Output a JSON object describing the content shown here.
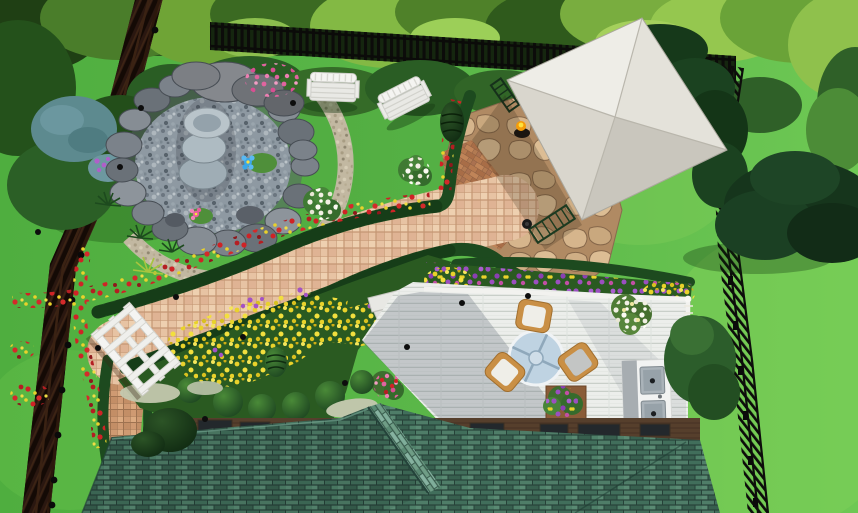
{
  "meta": {
    "kind": "3d-landscape-design-render",
    "view": "aerial top-down backyard garden",
    "canvas": "858x513"
  },
  "scene": {
    "objects": [
      {
        "name": "lawn",
        "label": "Green lawn"
      },
      {
        "name": "tree-canopy",
        "label": "Tree canopy along top edge"
      },
      {
        "name": "perimeter-fence",
        "label": "Dark picket perimeter fence (left, top, right)"
      },
      {
        "name": "garden-pond",
        "label": "Pebble pond with boulder ring and gravel border"
      },
      {
        "name": "tiered-fountain",
        "label": "Three-tier stone fountain"
      },
      {
        "name": "lily-pads",
        "label": "Lily pads with blue and pink blooms"
      },
      {
        "name": "garden-bench-1",
        "label": "White garden bench"
      },
      {
        "name": "garden-bench-2",
        "label": "White garden bench"
      },
      {
        "name": "gazebo-roof",
        "label": "Gazebo with ivory pyramidal roof"
      },
      {
        "name": "flagstone-patio",
        "label": "Flagstone patio under gazebo"
      },
      {
        "name": "paver-path",
        "label": "Winding pink paver walkway"
      },
      {
        "name": "brick-path",
        "label": "Brick walkway to house"
      },
      {
        "name": "white-arbor",
        "label": "White arbor over walkway"
      },
      {
        "name": "flower-beds",
        "label": "Red / yellow / purple flower beds"
      },
      {
        "name": "topiary-balls",
        "label": "Row of ball topiaries"
      },
      {
        "name": "spiral-topiary",
        "label": "Spiral topiary"
      },
      {
        "name": "cone-topiary",
        "label": "Cone topiary"
      },
      {
        "name": "wood-deck",
        "label": "White wood deck"
      },
      {
        "name": "patio-table",
        "label": "Round glass patio table"
      },
      {
        "name": "patio-chairs",
        "label": "Three wood patio chairs with white cushions"
      },
      {
        "name": "planter-box",
        "label": "Deck planter box"
      },
      {
        "name": "outdoor-kitchen",
        "label": "Outdoor kitchen / grill island"
      },
      {
        "name": "hanging-basket",
        "label": "Hanging flower basket"
      },
      {
        "name": "deck-steps",
        "label": "White steps from path to deck"
      },
      {
        "name": "house-roof",
        "label": "Green shingled house roof with dormer"
      },
      {
        "name": "upper-porch",
        "label": "Brown porch strip with dark panels"
      },
      {
        "name": "evergreen-tree",
        "label": "Large evergreen leaning over right fence"
      },
      {
        "name": "juniper-bush",
        "label": "Blue-gray juniper bush"
      },
      {
        "name": "landscape-lights",
        "label": "Small black landscape lights"
      },
      {
        "name": "torch",
        "label": "Lit torch by gazebo"
      }
    ]
  },
  "palette": {
    "lawn": "#58b446",
    "lawnLight": "#74ca52",
    "canopyDark": "#2d571f",
    "fenceBlack": "#0d0d0b",
    "fenceBrown": "#26130b",
    "hedge": "#1d4a1f",
    "bedSoil": "#2a5a21",
    "flowerRed": "#cf2326",
    "flowerYellow": "#e9d22b",
    "flowerPurple": "#9b4fc0",
    "flowerPink": "#e0649f",
    "flowerWhite": "#f2f0e4",
    "gazeboRoof": "#e8e6df",
    "deck": "#ecedea",
    "roofShingle": "#2f4f42",
    "porchBrown": "#563f2c",
    "paver": "#e7c3a3",
    "flagstone": "#b08a63",
    "pondPebble": "#8e99a2",
    "rock": "#7b828a",
    "stepsWhite": "#e8e8e4",
    "arborWhite": "#f4f4f2",
    "woodChair": "#c98f45",
    "tableGlass": "#bfd3e2",
    "steel": "#b9c1c6",
    "fountainStone": "#aebbc2"
  }
}
